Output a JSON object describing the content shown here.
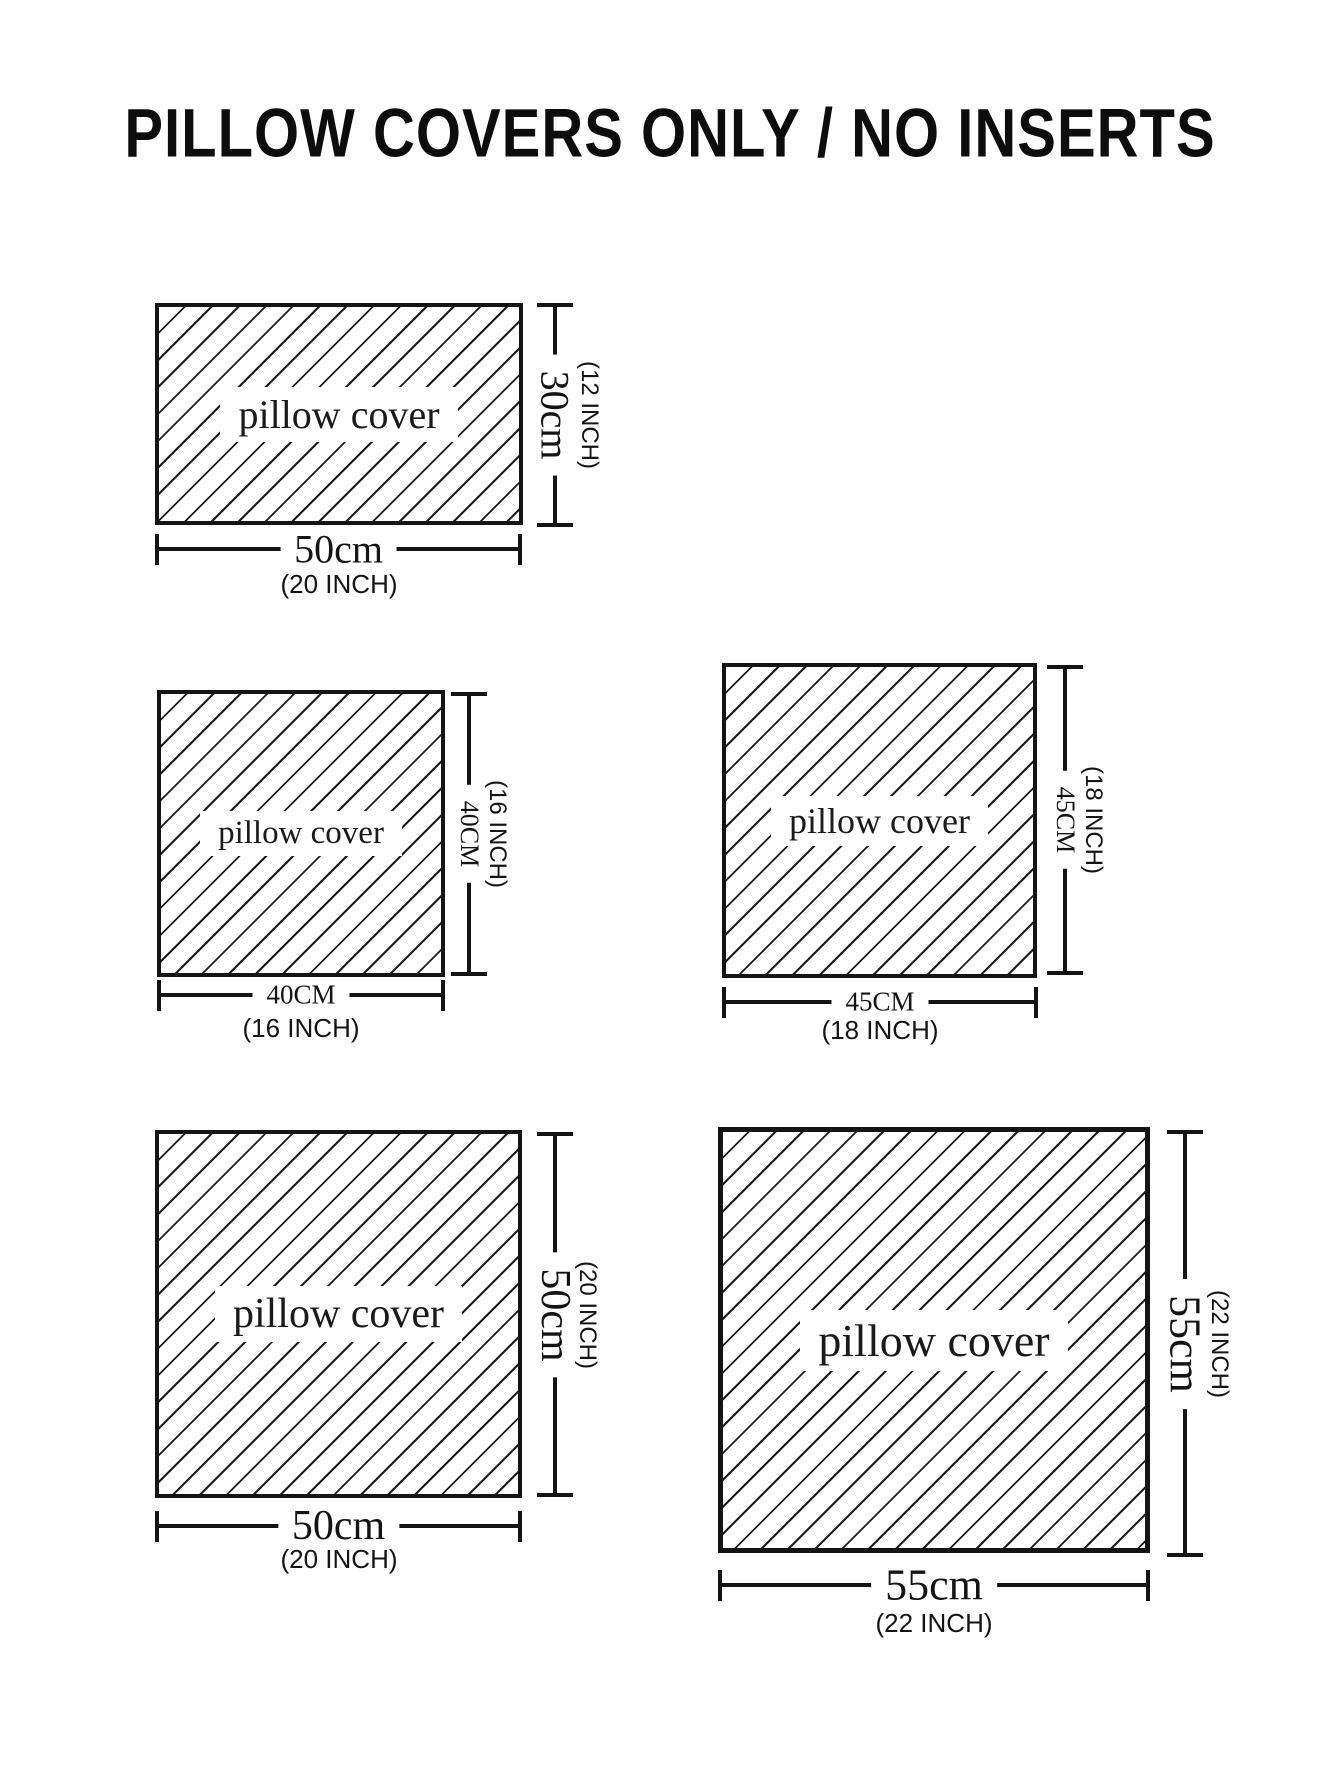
{
  "title": "PILLOW COVERS ONLY / NO INSERTS",
  "colors": {
    "ink": "#141414",
    "background": "#ffffff"
  },
  "pillows": [
    {
      "size": "50cm x 30cm",
      "cover_label": "pillow cover",
      "width_cm": "50cm",
      "width_inch": "(20 INCH)",
      "height_cm": "30cm",
      "height_inch": "(12 INCH)"
    },
    {
      "size": "40cm x 40cm",
      "cover_label": "pillow cover",
      "width_cm": "40CM",
      "width_inch": "(16 INCH)",
      "height_cm": "40CM",
      "height_inch": "(16 INCH)"
    },
    {
      "size": "45cm x 45cm",
      "cover_label": "pillow cover",
      "width_cm": "45CM",
      "width_inch": "(18 INCH)",
      "height_cm": "45CM",
      "height_inch": "(18 INCH)"
    },
    {
      "size": "50cm x 50cm",
      "cover_label": "pillow cover",
      "width_cm": "50cm",
      "width_inch": "(20 INCH)",
      "height_cm": "50cm",
      "height_inch": "(20 INCH)"
    },
    {
      "size": "55cm x 55cm",
      "cover_label": "pillow cover",
      "width_cm": "55cm",
      "width_inch": "(22 INCH)",
      "height_cm": "55cm",
      "height_inch": "(22 INCH)"
    }
  ]
}
